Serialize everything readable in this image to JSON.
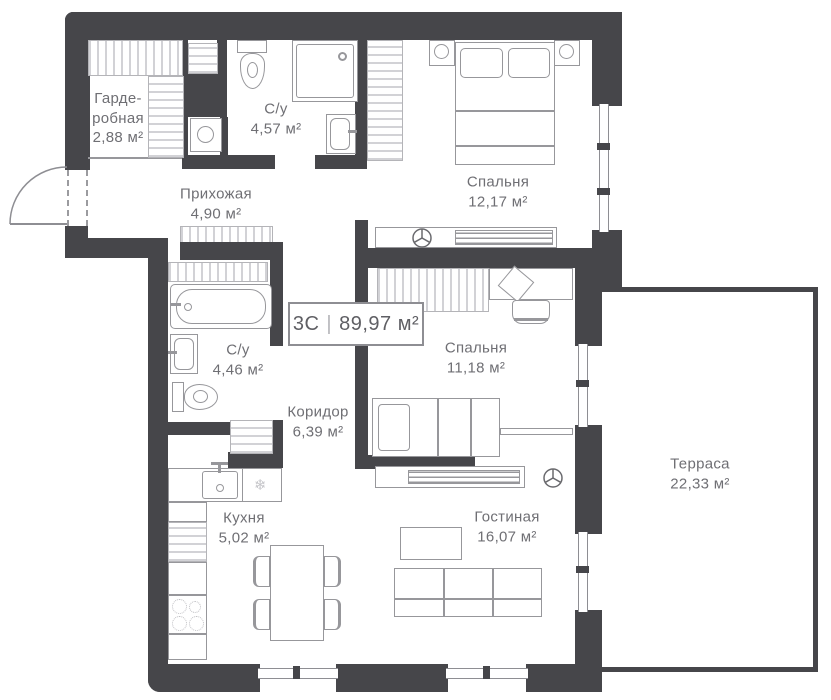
{
  "plan": {
    "type_label": "3С",
    "separator": "|",
    "total_area": "89,97 м²"
  },
  "rooms": [
    {
      "id": "wardrobe",
      "name": "Гарде-",
      "name2": "робная",
      "area": "2,88 м²"
    },
    {
      "id": "bathroom-1",
      "name": "С/у",
      "area": "4,57 м²"
    },
    {
      "id": "hallway",
      "name": "Прихожая",
      "area": "4,90 м²"
    },
    {
      "id": "bedroom-1",
      "name": "Спальня",
      "area": "12,17 м²"
    },
    {
      "id": "bathroom-2",
      "name": "С/у",
      "area": "4,46 м²"
    },
    {
      "id": "corridor",
      "name": "Коридор",
      "area": "6,39 м²"
    },
    {
      "id": "bedroom-2",
      "name": "Спальня",
      "area": "11,18 м²"
    },
    {
      "id": "kitchen",
      "name": "Кухня",
      "area": "5,02 м²"
    },
    {
      "id": "living",
      "name": "Гостиная",
      "area": "16,07 м²"
    },
    {
      "id": "terrace",
      "name": "Терраса",
      "area": "22,33 м²"
    }
  ],
  "colors": {
    "wall": "#46464a",
    "furniture_line": "#97979b",
    "text": "#6f6f74"
  }
}
